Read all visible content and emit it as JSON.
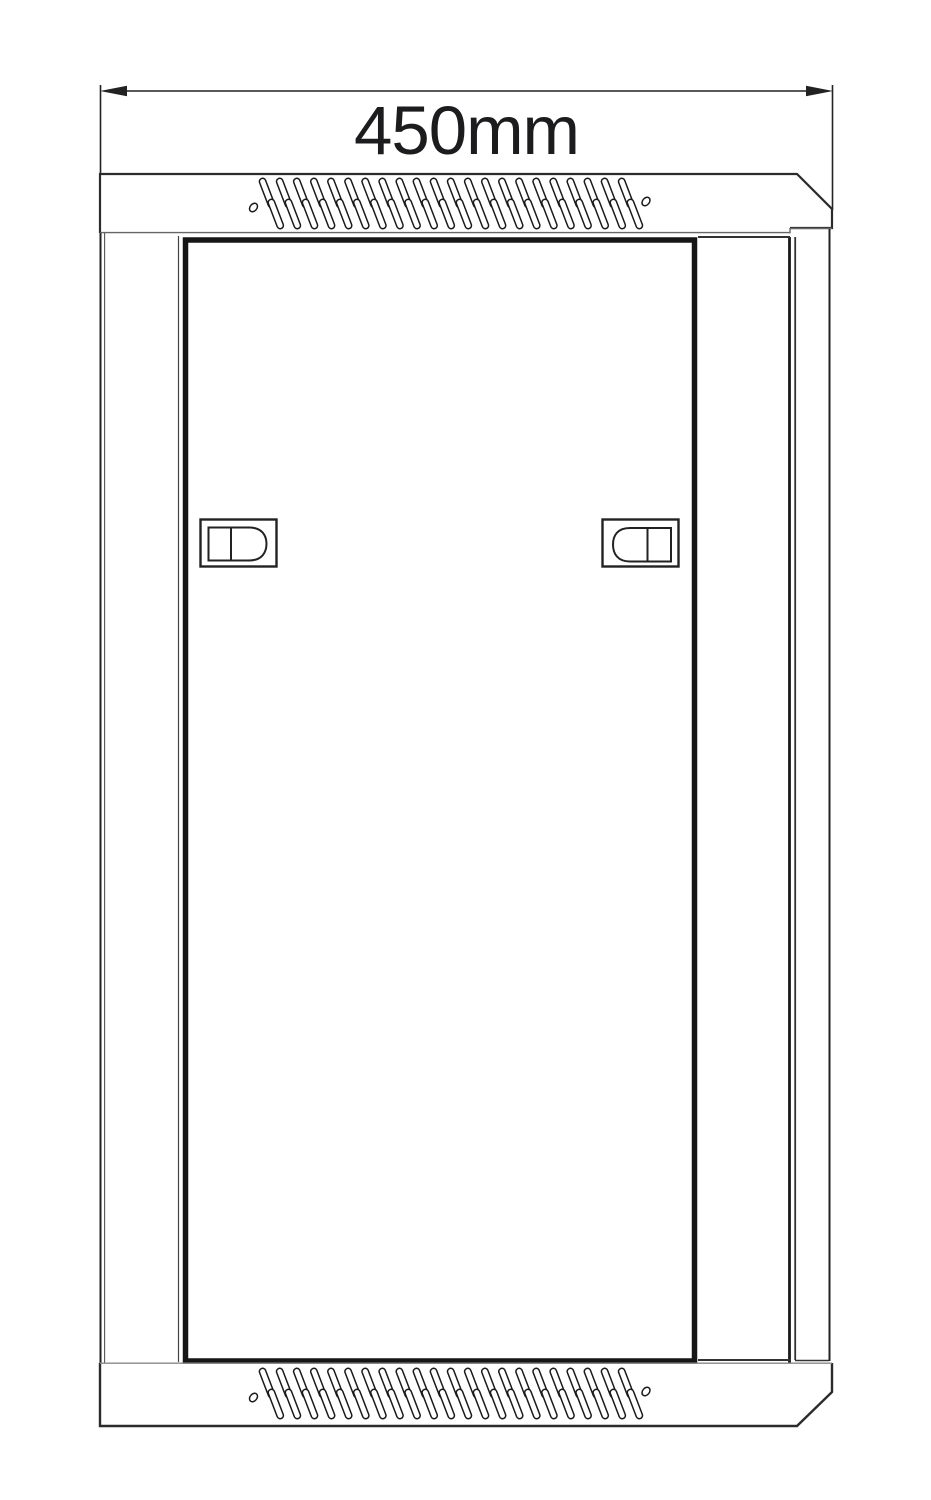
{
  "drawing": {
    "dimension": {
      "label": "450mm"
    },
    "colors": {
      "line": "#222222",
      "door_line": "#161616",
      "light_line": "#8a8a8a",
      "background": "#ffffff"
    },
    "vents": {
      "columns": 22
    }
  }
}
